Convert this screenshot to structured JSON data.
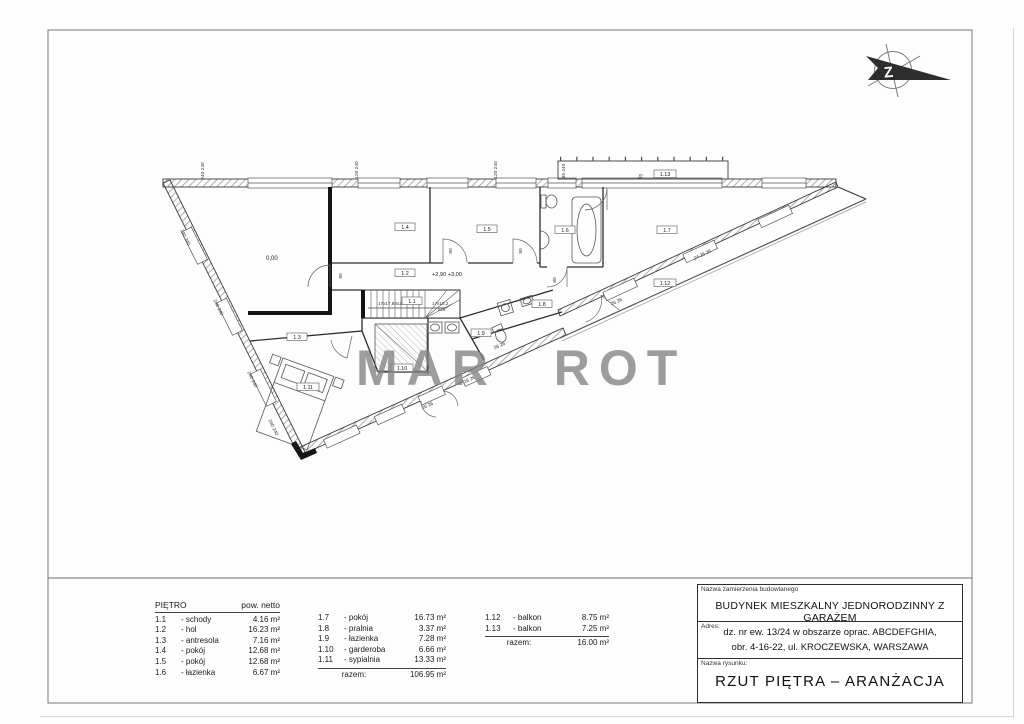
{
  "watermark": {
    "text": "MAR ROT"
  },
  "north": {
    "letter": "Z"
  },
  "plan": {
    "levels": {
      "ground": "0,00",
      "upper": "+2,90 +3,00"
    },
    "stairs": {
      "left": "17x17,85x27",
      "right": "17x18,2",
      "right2": "x28"
    },
    "rooms": [
      "1.1",
      "1.2",
      "1.3",
      "1.4",
      "1.5",
      "1.6",
      "1.7",
      "1.8",
      "1.9",
      "1.10",
      "1.11",
      "1.12",
      "1.13"
    ],
    "dims": [
      "240 240",
      "120 240",
      "120 240",
      "85 240",
      "85",
      "240 240",
      "240 240",
      "240 240",
      "240 240",
      "26 26",
      "24 26 26",
      "26 26",
      "26 26",
      "26 26",
      "90",
      "90",
      "80",
      "90"
    ]
  },
  "legend": {
    "title": "PIĘTRO",
    "area_header": "pow. netto",
    "razem_label": "razem:",
    "col1": [
      {
        "no": "1.1",
        "name": "- schody",
        "area": "4.16 m²"
      },
      {
        "no": "1.2",
        "name": "- hol",
        "area": "16.23 m²"
      },
      {
        "no": "1.3",
        "name": "- antresola",
        "area": "7.16 m²"
      },
      {
        "no": "1.4",
        "name": "- pokój",
        "area": "12.68 m²"
      },
      {
        "no": "1.5",
        "name": "- pokój",
        "area": "12.68 m²"
      },
      {
        "no": "1.6",
        "name": "- łazienka",
        "area": "6.67 m²"
      }
    ],
    "col2": [
      {
        "no": "1.7",
        "name": "- pokój",
        "area": "16.73 m²"
      },
      {
        "no": "1.8",
        "name": "- pralnia",
        "area": "3.37 m²"
      },
      {
        "no": "1.9",
        "name": "- łazienka",
        "area": "7.28 m²"
      },
      {
        "no": "1.10",
        "name": "- garderoba",
        "area": "6.66 m²"
      },
      {
        "no": "1.11",
        "name": "- sypialnia",
        "area": "13.33 m²"
      }
    ],
    "col2_total": "106.95 m²",
    "col3": [
      {
        "no": "1.12",
        "name": "- balkon",
        "area": "8.75 m²"
      },
      {
        "no": "1.13",
        "name": "- balkon",
        "area": "7.25 m²"
      }
    ],
    "col3_total": "16.00 m²"
  },
  "title_block": {
    "project_label": "Nazwa zamierzenia budowlanego",
    "project": "BUDYNEK MIESZKALNY JEDNORODZINNY Z GARAŻEM",
    "address_label": "Adres:",
    "address_line1": "dz. nr ew. 13/24 w obszarze oprac. ABCDEFGHIA,",
    "address_line2": "obr. 4-16-22, ul. KROCZEWSKA, WARSZAWA",
    "drawing_label": "Nazwa rysunku:",
    "drawing_name": "RZUT PIĘTRA – ARANŻACJA"
  }
}
